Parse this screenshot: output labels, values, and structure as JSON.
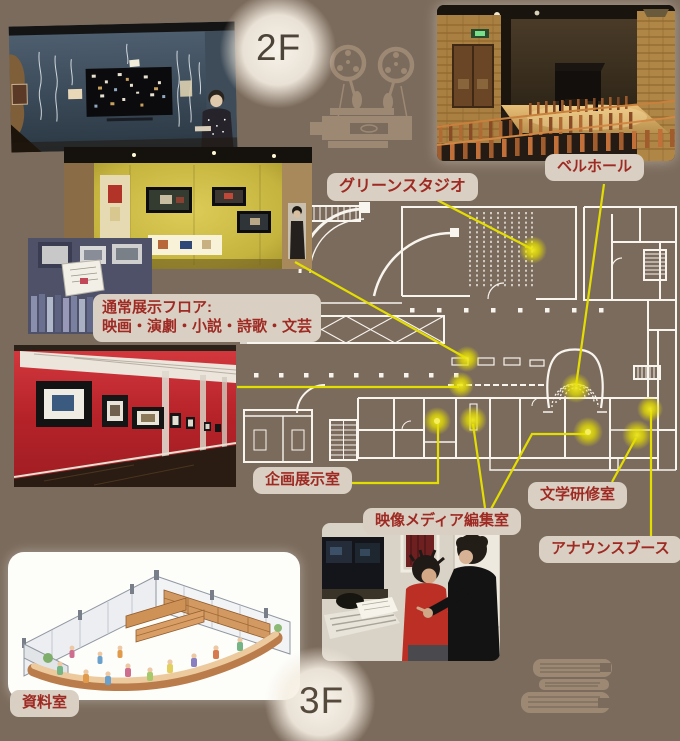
{
  "page": {
    "floor_upper": "2F",
    "floor_lower": "3F"
  },
  "labels": {
    "green_studio": "グリーンスタジオ",
    "bell_hall": "ベルホール",
    "regular_exhibition_title": "通常展示フロア:",
    "regular_exhibition_genres": "映画・演劇・小説・詩歌・文芸",
    "planned_exhibition_room": "企画展示室",
    "video_media_editing_room": "映像メディア編集室",
    "literature_seminar_room": "文学研修室",
    "announce_booth": "アナウンスブース",
    "reference_room": "資料室"
  },
  "icons": {
    "film_projector": "film-projector-icon",
    "book_stack": "book-stack-icon"
  },
  "colors": {
    "background": "#7b6b5c",
    "floorplan_line": "#f8f4ee",
    "connector_yellow": "#e4dd00",
    "label_background": "#d9cfc2",
    "label_text": "#9e2a23",
    "icon_brown": "#9d8873"
  }
}
